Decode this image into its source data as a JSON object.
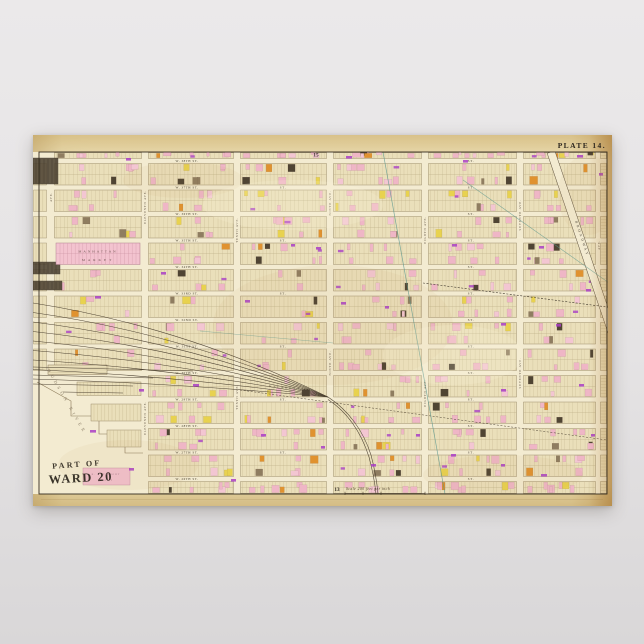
{
  "poster": {
    "plate_label": "PLATE 14.",
    "ref_top": "15",
    "ref_bottom": "13",
    "stamp_line1": "PART OF",
    "stamp_line2": "WARD 20",
    "scale_text": "Scale 200 feet per inch",
    "river_label": "HUDSON RIVER",
    "market_line1": "MANHATTAN",
    "market_line2": "MARKET",
    "depot_line1": "R. R. FREIGHT",
    "depot_line2": "DEPOT",
    "broadway_label": "BROADWAY",
    "rail_line_label": "N. Y. C. & H. R. R. R. LINE",
    "street_secondary_label": "ST."
  },
  "map": {
    "streets": [
      {
        "name": "W. 38TH ST.",
        "y": 26
      },
      {
        "name": "W. 37TH ST.",
        "y": 52.5
      },
      {
        "name": "W. 36TH ST.",
        "y": 79
      },
      {
        "name": "W. 35TH ST.",
        "y": 105.5
      },
      {
        "name": "W. 34TH ST.",
        "y": 132
      },
      {
        "name": "W. 33RD ST.",
        "y": 158.5
      },
      {
        "name": "W. 32ND ST.",
        "y": 185
      },
      {
        "name": "W. 31ST ST.",
        "y": 211.5
      },
      {
        "name": "W. 30TH ST.",
        "y": 238
      },
      {
        "name": "W. 29TH ST.",
        "y": 264.5
      },
      {
        "name": "W. 28TH ST.",
        "y": 291
      },
      {
        "name": "W. 27TH ST.",
        "y": 317.5
      },
      {
        "name": "W. 26TH ST.",
        "y": 344
      }
    ],
    "avenues": [
      {
        "name": "AVE.",
        "x": 18,
        "label_ys": [
          62
        ]
      },
      {
        "name": "ELEVENTH AVE.",
        "x": 112,
        "label_ys": [
          72,
          283
        ]
      },
      {
        "name": "TENTH AVE.",
        "x": 204,
        "label_ys": [
          95,
          262
        ]
      },
      {
        "name": "NINTH AVE.",
        "x": 297,
        "label_ys": [
          68,
          228
        ]
      },
      {
        "name": "EIGHTH AVE.",
        "x": 392,
        "label_ys": [
          95,
          258
        ]
      },
      {
        "name": "SEVENTH AVE.",
        "x": 487,
        "label_ys": [
          80,
          238
        ]
      },
      {
        "name": "AVE.",
        "x": 566,
        "label_ys": [
          110
        ]
      }
    ],
    "annotations": [
      [
        93,
        23,
        5
      ],
      [
        313,
        21,
        6
      ],
      [
        430,
        25,
        5
      ],
      [
        544,
        20,
        6
      ],
      [
        566,
        38,
        4
      ],
      [
        62,
        161,
        6
      ],
      [
        212,
        165,
        5
      ],
      [
        308,
        167,
        5
      ],
      [
        352,
        171,
        4
      ],
      [
        468,
        188,
        5
      ],
      [
        523,
        189,
        5
      ],
      [
        258,
        109,
        4
      ],
      [
        283,
        112,
        5
      ],
      [
        419,
        109,
        5
      ],
      [
        506,
        111,
        5
      ],
      [
        128,
        137,
        5
      ],
      [
        160,
        249,
        6
      ],
      [
        106,
        254,
        5
      ],
      [
        57,
        295,
        6
      ],
      [
        228,
        299,
        5
      ],
      [
        288,
        311,
        4
      ],
      [
        338,
        329,
        5
      ],
      [
        418,
        319,
        5
      ],
      [
        468,
        329,
        4
      ],
      [
        508,
        339,
        6
      ],
      [
        546,
        249,
        5
      ],
      [
        558,
        299,
        4
      ],
      [
        198,
        344,
        5
      ],
      [
        383,
        299,
        4
      ],
      [
        553,
        154,
        5
      ],
      [
        468,
        254,
        5
      ],
      [
        96,
        333,
        5
      ]
    ],
    "colors": {
      "street_fill": "#f3ebd1",
      "block_fill": "#eadfba",
      "frame": "#352d20",
      "line": "#8a7958",
      "lot": "#b6a77f",
      "pink": "#efb6c6",
      "pink2": "#f3c6d2",
      "yellow": "#e8d24f",
      "brown": "#8f7d60",
      "dark": "#4f4433",
      "orange": "#e0922f",
      "purple": "#a93ec6",
      "teal": "#55948c",
      "rail": "#4d4232",
      "text": "#3c3526",
      "ave_text": "#5a4d3e"
    }
  }
}
